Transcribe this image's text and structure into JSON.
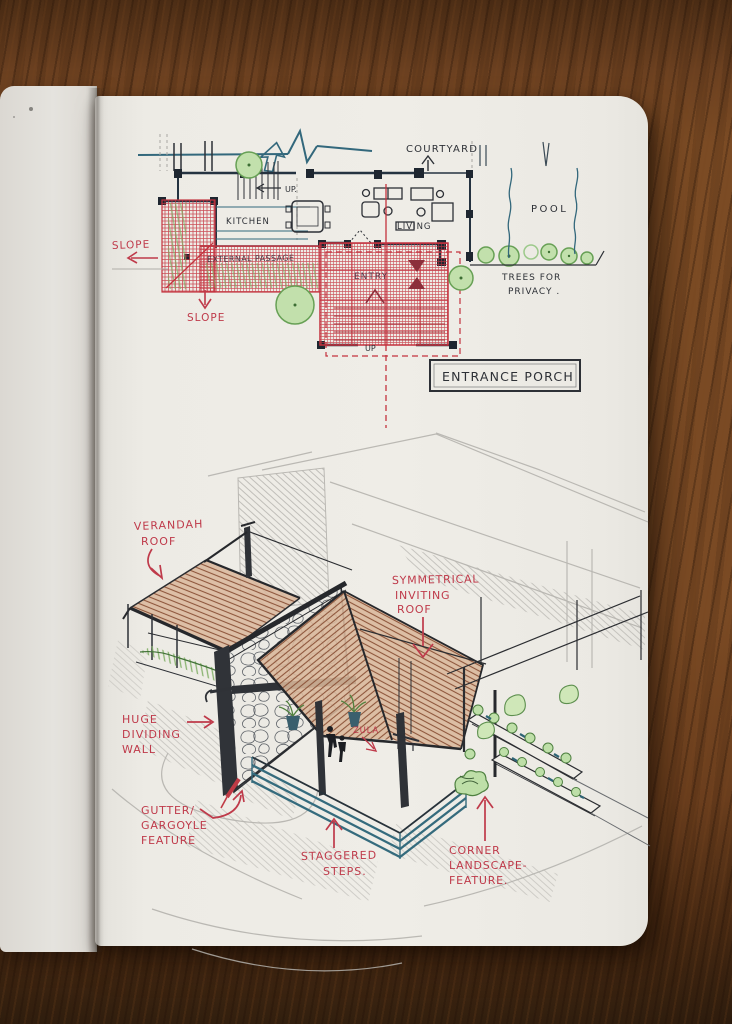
{
  "colors": {
    "red_ink": "#bf3a4a",
    "plan_red": "#c4323e",
    "maroon_ink": "#8c2f3b",
    "dark_ink": "#2d3036",
    "teal_ink": "#33687c",
    "green_fill": "#c2e0ac",
    "green_stroke": "#67a055",
    "roof_fill": "#d8b296",
    "roof_slat": "#8a5136",
    "pencil": "#b0aea9",
    "paper": "#efede7",
    "wood": "#7a4a24"
  },
  "plan": {
    "labels": {
      "courtyard": "COURTYARD",
      "pool": "POOL",
      "kitchen": "KITCHEN",
      "living": "LIVING",
      "up_stairs": "UP.",
      "up_porch": "UP",
      "entry": "ENTRY",
      "external_passage": "EXTERNAL PASSAGE",
      "slope_left": "SLOPE",
      "slope_bottom": "SLOPE",
      "trees_line1": "TREES FOR",
      "trees_line2": "PRIVACY .",
      "title": "ENTRANCE PORCH"
    }
  },
  "perspective": {
    "labels": {
      "verandah_line1": "VERANDAH",
      "verandah_line2": "ROOF",
      "symmetrical_line1": "SYMMETRICAL",
      "symmetrical_line2": "INVITING",
      "symmetrical_line3": "ROOF",
      "wall_line1": "HUGE",
      "wall_line2": "DIVIDING",
      "wall_line3": "WALL",
      "gutter_line1": "GUTTER/",
      "gutter_line2": "GARGOYLE",
      "gutter_line3": "FEATURE",
      "steps_line1": "STAGGERED",
      "steps_line2": "STEPS.",
      "corner_line1": "CORNER",
      "corner_line2": "LANDSCAPE-",
      "corner_line3": "FEATURE.",
      "zula": "ZULA"
    }
  }
}
